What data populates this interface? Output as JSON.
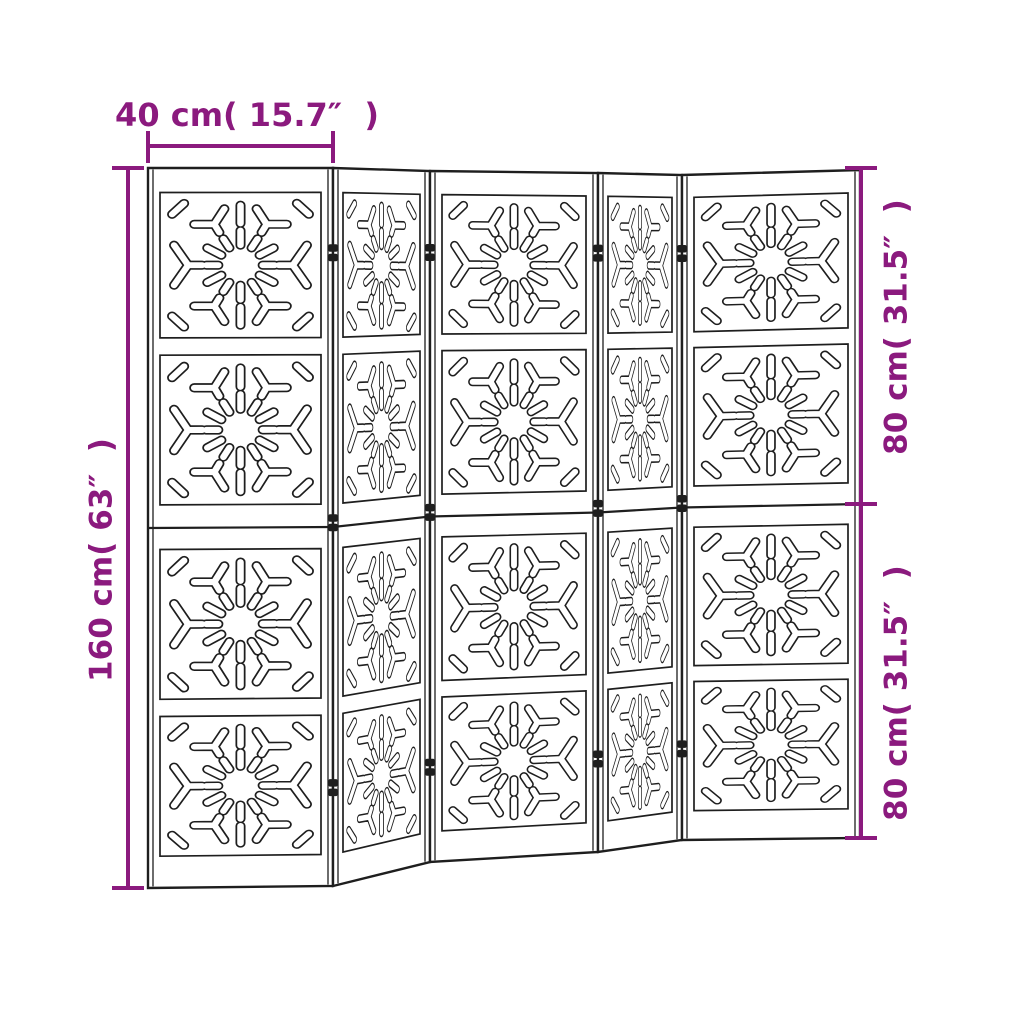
{
  "canvas": {
    "width": 1024,
    "height": 1024,
    "background": "#ffffff"
  },
  "palette": {
    "dimension_accent": "#8b1a7e",
    "drawing_line": "#1e1e1e",
    "panel_fill": "#ffffff"
  },
  "dimension_labels": {
    "panel_width": "40 cm( 15.7″  )",
    "total_height": "160 cm( 63″  )",
    "upper_half_height": "80 cm( 31.5″  )",
    "lower_half_height": "80 cm( 31.5″  )"
  },
  "divider": {
    "panel_count": 5,
    "sections_per_panel": 4,
    "junction_count": 4,
    "hinges_per_junction": 3
  }
}
